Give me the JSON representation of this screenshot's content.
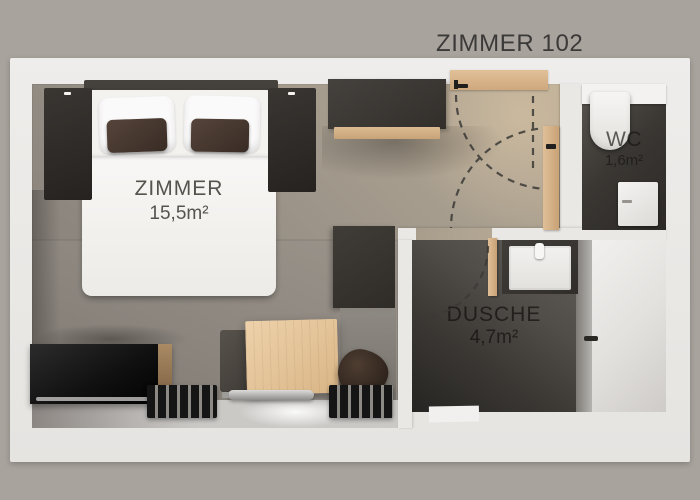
{
  "title": "ZIMMER 102",
  "rooms": {
    "bedroom": {
      "label": "ZIMMER",
      "area": "15,5m²"
    },
    "shower": {
      "label": "DUSCHE",
      "area": "4,7m²"
    },
    "wc": {
      "label": "WC",
      "area": "1,6m²"
    }
  },
  "colors": {
    "background": "#a8a39d",
    "wall_white": "#eae8e5",
    "bedroom_floor": "#9a938a",
    "wet_room_floor": "#34312d",
    "wood_accent": "#d9b88e",
    "dark_furniture": "#35322e",
    "label_text": "#3b3a38"
  }
}
